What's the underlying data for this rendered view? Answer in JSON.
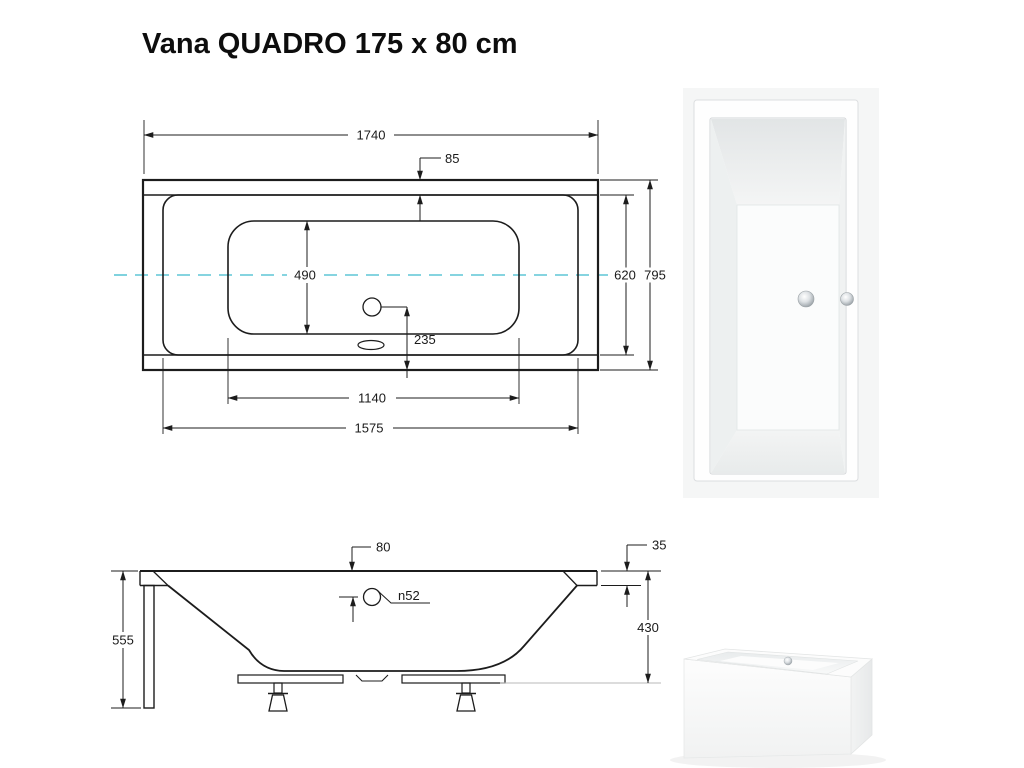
{
  "title": "Vana QUADRO 175 x 80 cm",
  "plan": {
    "label": "top view technical drawing",
    "dims": {
      "outer_length": "1740",
      "rim_width": "85",
      "basin_width": "490",
      "inner_width": "620",
      "outer_width": "795",
      "drain_offset": "235",
      "basin_length": "1140",
      "inner_length": "1575"
    }
  },
  "side": {
    "label": "side view technical drawing",
    "dims": {
      "drain_top_offset": "80",
      "rim_height": "35",
      "drain_diameter": "n52",
      "total_height": "555",
      "body_depth": "430"
    }
  },
  "colors": {
    "centerline": "#5fc6d6",
    "line": "#1c1c1c",
    "photo_background": "#f5f6f6"
  }
}
